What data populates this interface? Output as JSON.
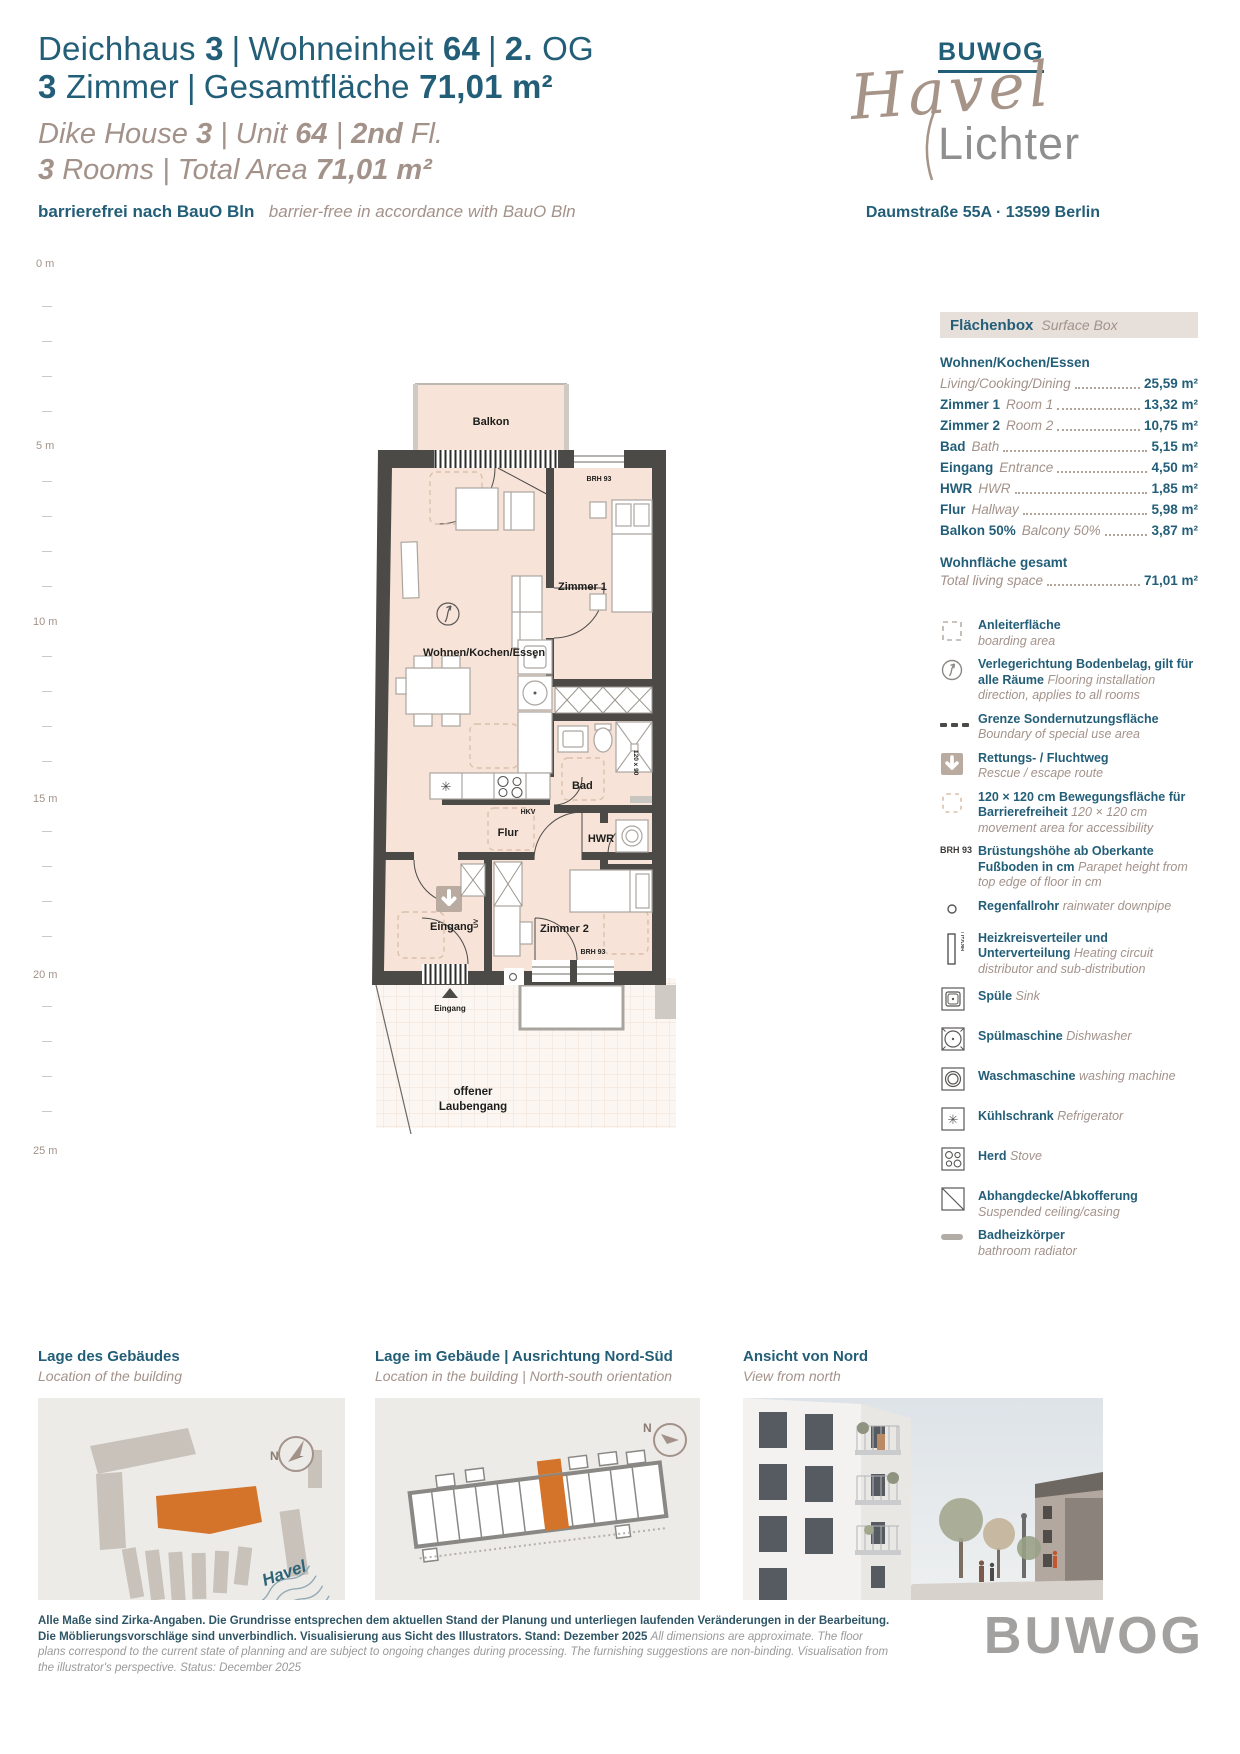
{
  "header": {
    "sep": "|",
    "de1_1": "Deichhaus",
    "de1_1b": "3",
    "de1_2": "Wohneinheit",
    "de1_2b": "64",
    "de1_3b": "2.",
    "de1_3": "OG",
    "de2_1b": "3",
    "de2_1": "Zimmer",
    "de2_2": "Gesamtfläche",
    "de2_2b": "71,01 m²",
    "en1_1": "Dike House",
    "en1_1b": "3",
    "en1_2": "Unit",
    "en1_2b": "64",
    "en1_3b": "2nd",
    "en1_3": "Fl.",
    "en2_1b": "3",
    "en2_1": "Rooms",
    "en2_2": "Total Area",
    "en2_2b": "71,01 m²",
    "barrier_de": "barrierefrei nach BauO Bln",
    "barrier_en": "barrier-free in accordance with BauO Bln"
  },
  "logo": {
    "buwog": "BUWOG",
    "script": "Havel",
    "sub": "Lichter",
    "address": "Daumstraße 55A · 13599 Berlin"
  },
  "scale": [
    "0 m",
    "5 m",
    "10 m",
    "15 m",
    "20 m",
    "25 m"
  ],
  "plan": {
    "balkon": "Balkon",
    "zimmer1": "Zimmer 1",
    "wohnen": "Wohnen/Kochen/Essen",
    "bad": "Bad",
    "flur": "Flur",
    "hwr": "HWR",
    "eingang": "Eingang",
    "zimmer2": "Zimmer 2",
    "laubengang1": "offener",
    "laubengang2": "Laubengang",
    "brh_top": "BRH 93",
    "brh_bottom": "BRH 93",
    "hkv": "HKV",
    "uv": "UV",
    "shower": "120 x 90",
    "entry_label": "Eingang"
  },
  "surface": {
    "title_de": "Flächenbox",
    "title_en": "Surface Box",
    "rows": [
      {
        "de": "Wohnen/Kochen/Essen",
        "en": "Living/Cooking/Dining",
        "value": "25,59 m²"
      },
      {
        "de": "Zimmer 1",
        "en": "Room 1",
        "value": "13,32 m²"
      },
      {
        "de": "Zimmer 2",
        "en": "Room 2",
        "value": "10,75 m²"
      },
      {
        "de": "Bad",
        "en": "Bath",
        "value": "5,15 m²"
      },
      {
        "de": "Eingang",
        "en": "Entrance",
        "value": "4,50 m²"
      },
      {
        "de": "HWR",
        "en": "HWR",
        "value": "1,85 m²"
      },
      {
        "de": "Flur",
        "en": "Hallway",
        "value": "5,98 m²"
      },
      {
        "de": "Balkon 50%",
        "en": "Balcony 50%",
        "value": "3,87 m²"
      }
    ],
    "total_de": "Wohnfläche gesamt",
    "total_en": "Total living space",
    "total_value": "71,01 m²"
  },
  "legend": [
    {
      "icon": "boarding-area",
      "de": "Anleiterfläche",
      "en": "boarding area"
    },
    {
      "icon": "flooring-direction",
      "de": "Verlegerichtung Bodenbelag, gilt für alle Räume",
      "en": "Flooring installation direction, applies to all rooms"
    },
    {
      "icon": "special-use-boundary",
      "de": "Grenze Sondernutzungsfläche",
      "en": "Boundary of special use area"
    },
    {
      "icon": "escape-route",
      "de": "Rettungs- / Fluchtweg",
      "en": "Rescue / escape route"
    },
    {
      "icon": "movement-area",
      "de": "120 × 120 cm Bewegungsfläche für Barrierefreiheit",
      "en": "120 × 120 cm movement area for accessibility"
    },
    {
      "icon": "parapet-height",
      "label": "BRH 93",
      "de": "Brüstungshöhe ab Oberkante Fußboden in cm",
      "en": "Parapet height from top edge of floor in cm"
    },
    {
      "icon": "rainwater-downpipe",
      "de": "Regenfallrohr",
      "en": "rainwater downpipe"
    },
    {
      "icon": "heating-distributor",
      "label": "HKV+LM",
      "de": "Heizkreisverteiler und Unterverteilung",
      "en": "Heating circuit distributor and sub-distribution"
    },
    {
      "icon": "sink",
      "de": "Spüle",
      "en": "Sink"
    },
    {
      "icon": "dishwasher",
      "de": "Spülmaschine",
      "en": "Dishwasher"
    },
    {
      "icon": "washing-machine",
      "de": "Waschmaschine",
      "en": "washing machine"
    },
    {
      "icon": "refrigerator",
      "de": "Kühlschrank",
      "en": "Refrigerator"
    },
    {
      "icon": "stove",
      "de": "Herd",
      "en": "Stove"
    },
    {
      "icon": "suspended-ceiling",
      "de": "Abhangdecke/Abkofferung",
      "en": "Suspended ceiling/casing"
    },
    {
      "icon": "bathroom-radiator",
      "de": "Badheizkörper",
      "en": "bathroom radiator"
    }
  ],
  "panels": {
    "compass": "N",
    "river": "Havel",
    "p1_de": "Lage des Gebäudes",
    "p1_en": "Location of the building",
    "p2_de": "Lage im Gebäude | Ausrichtung Nord-Süd",
    "p2_en": "Location in the building | North-south orientation",
    "p3_de": "Ansicht von Nord",
    "p3_en": "View from north"
  },
  "footer": {
    "de": "Alle Maße sind Zirka-Angaben. Die Grundrisse entsprechen dem aktuellen Stand der Planung und unterliegen laufenden Veränderungen in der Bearbeitung. Die Möblierungsvorschläge sind unverbindlich. Visualisierung aus Sicht des Illustrators. Stand: Dezember 2025",
    "en": "All dimensions are approximate. The floor plans correspond to the current state of planning and are subject to ongoing changes during processing. The furnishing suggestions are non-binding. Visualisation from the illustrator's perspective. Status: December 2025",
    "logo": "BUWOG"
  }
}
